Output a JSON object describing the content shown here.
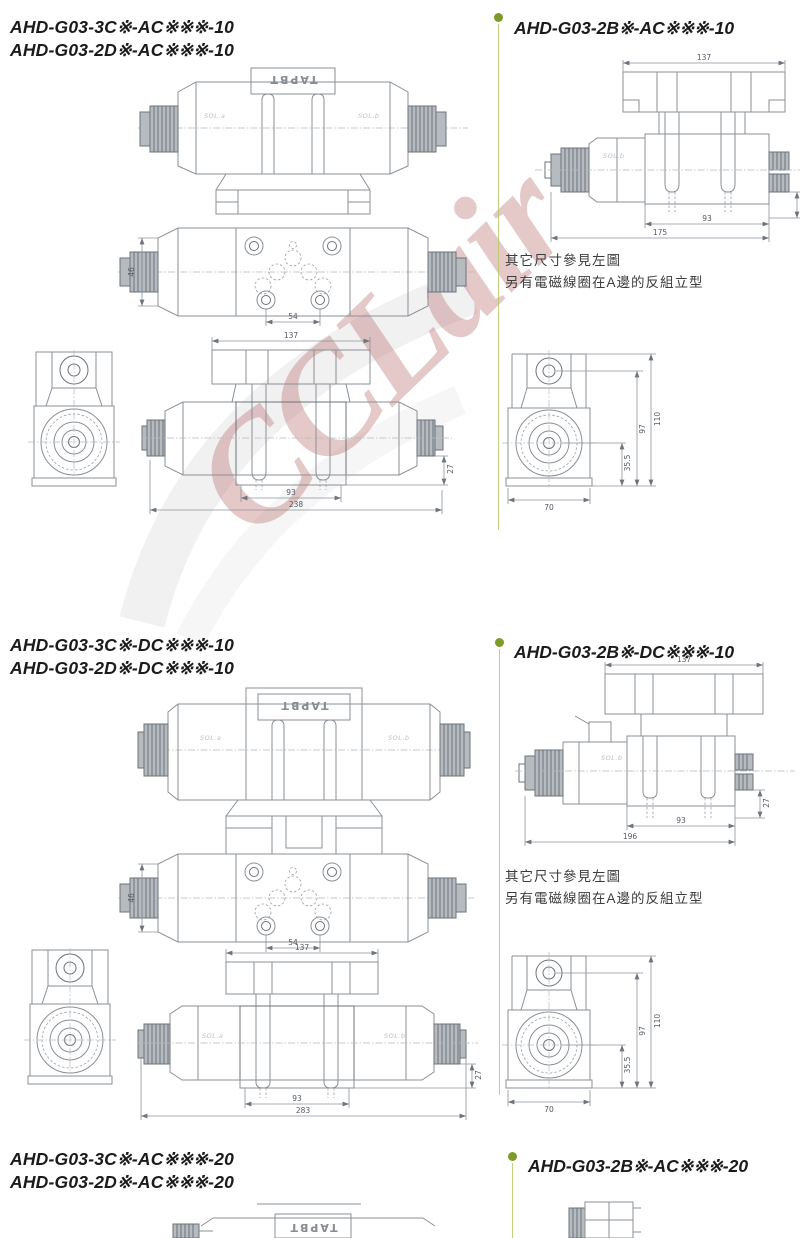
{
  "watermark": {
    "text": "CCLair",
    "color": "#bb6e6e"
  },
  "drawing_labels": {
    "sol_a": "SOL.a",
    "sol_b": "SOL.b",
    "nameplate": "TAPBT"
  },
  "sections": [
    {
      "left_models": [
        "AHD-G03-3C※-AC※※※-10",
        "AHD-G03-2D※-AC※※※-10"
      ],
      "right_model": "AHD-G03-2B※-AC※※※-10",
      "notes": [
        "其它尺寸參見左圖",
        "另有電磁線圈在A邊的反組立型"
      ],
      "dims": {
        "body_height": "46",
        "port_span": "54",
        "plate_width": "137",
        "bolt_span": "93",
        "total_length": "238",
        "side_offset": "27",
        "right_total_length": "175",
        "end_height": "110",
        "end_top": "97",
        "end_mid": "35.5",
        "end_base": "70"
      }
    },
    {
      "left_models": [
        "AHD-G03-3C※-DC※※※-10",
        "AHD-G03-2D※-DC※※※-10"
      ],
      "right_model": "AHD-G03-2B※-DC※※※-10",
      "notes": [
        "其它尺寸參見左圖",
        "另有電磁線圈在A邊的反組立型"
      ],
      "dims": {
        "body_height": "46",
        "port_span": "54",
        "plate_width": "137",
        "bolt_span": "93",
        "total_length": "283",
        "side_offset": "27",
        "right_total_length": "196",
        "end_height": "110",
        "end_top": "97",
        "end_mid": "35.5",
        "end_base": "70"
      }
    },
    {
      "left_models": [
        "AHD-G03-3C※-AC※※※-20",
        "AHD-G03-2D※-AC※※※-20"
      ],
      "right_model": "AHD-G03-2B※-AC※※※-20"
    }
  ]
}
